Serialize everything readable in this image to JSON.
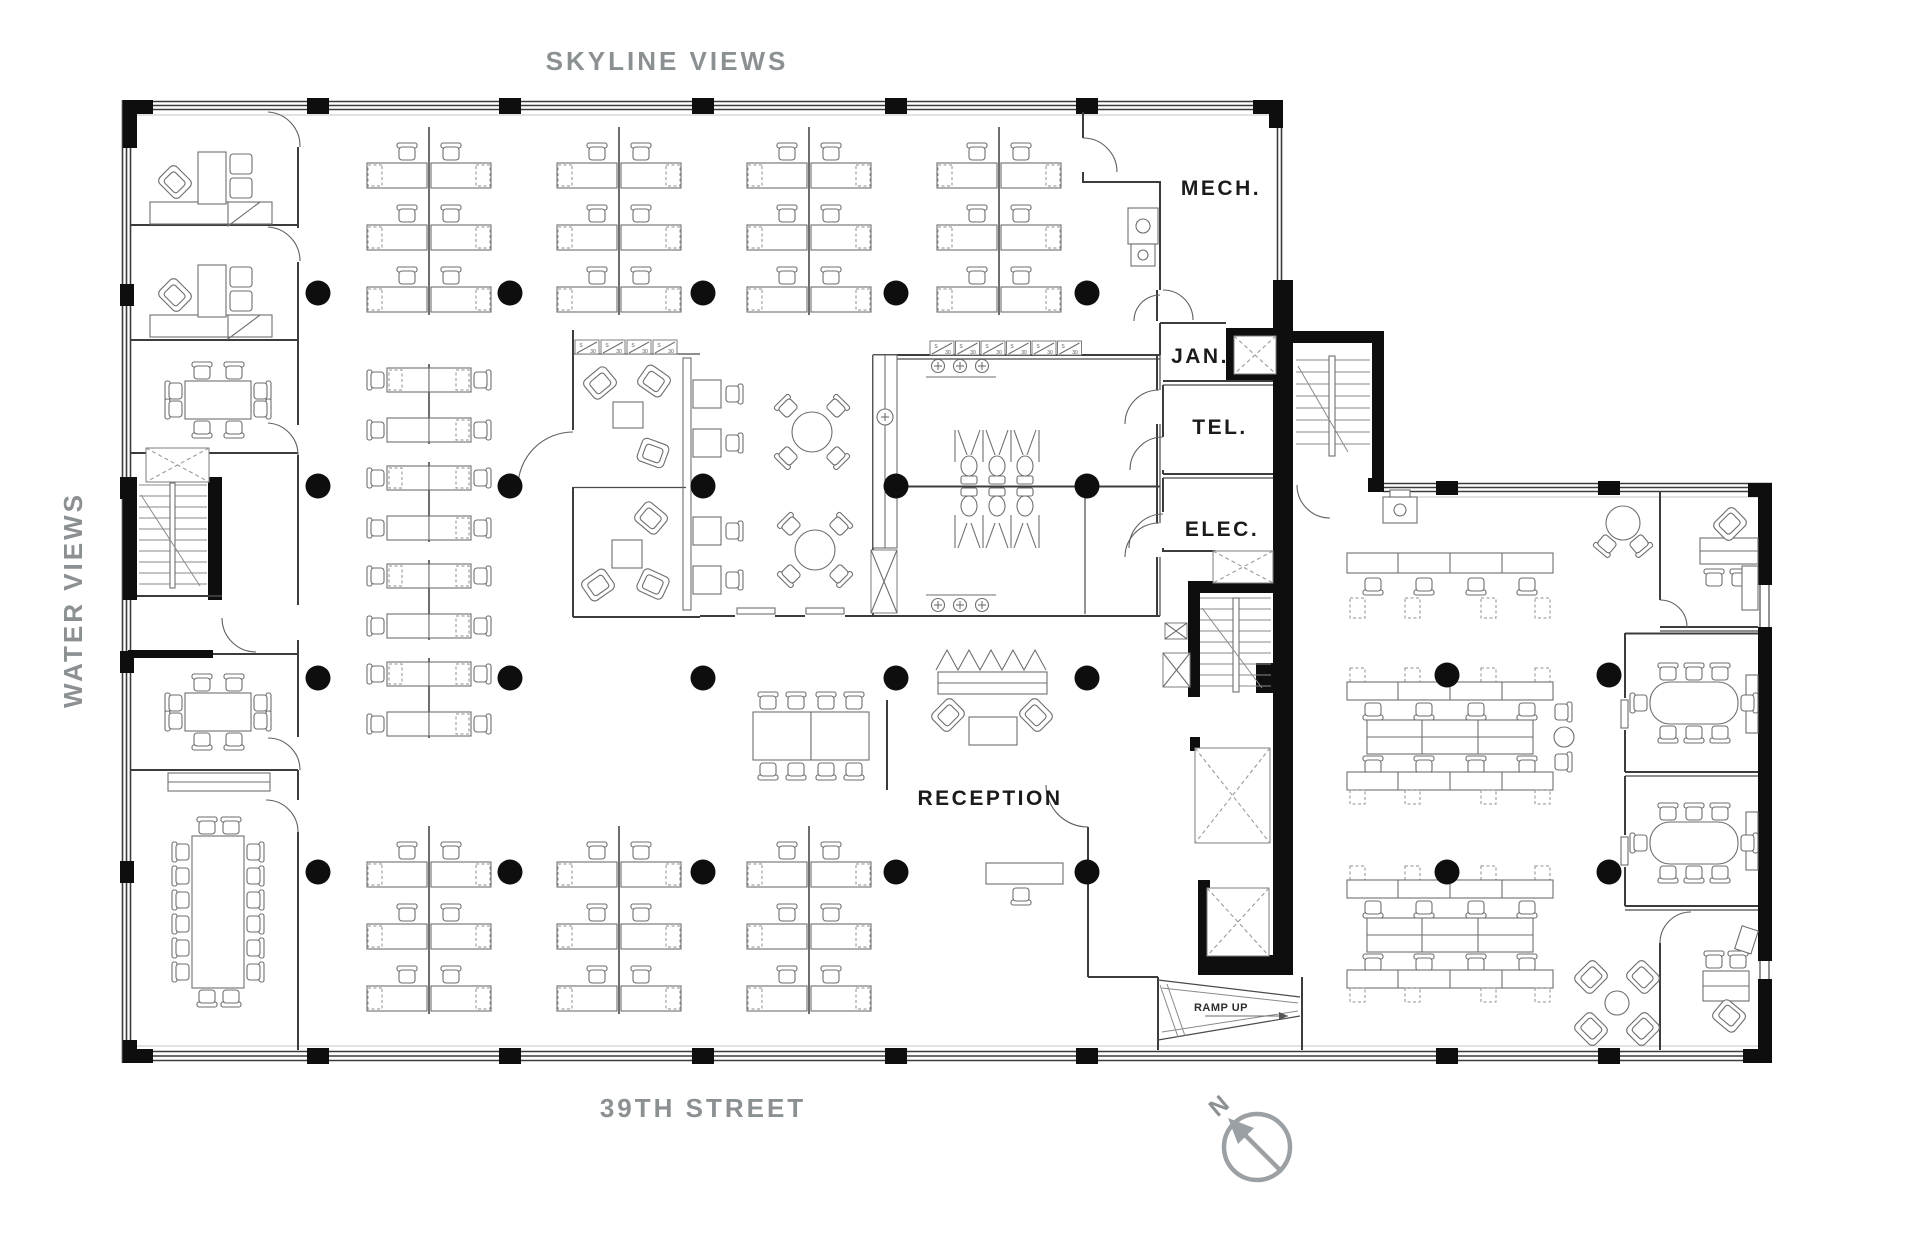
{
  "street_labels": {
    "top": "SKYLINE VIEWS",
    "left": "WATER VIEWS",
    "bottom": "39TH STREET"
  },
  "room_labels": {
    "mech": "MECH.",
    "jan": "JAN.",
    "tel": "TEL.",
    "elec": "ELEC.",
    "reception": "RECEPTION"
  },
  "annotations": {
    "ramp": "RAMP UP",
    "compass_north": "N",
    "storage_s": "S",
    "storage_size": "30"
  },
  "colors": {
    "background": "#ffffff",
    "walls": "#3c3c3c",
    "furniture": "#6e6e6e",
    "columns": "#0e0e0e",
    "street_text": "#8b9093",
    "room_text": "#1b1b1b",
    "compass": "#9aa0a3"
  }
}
